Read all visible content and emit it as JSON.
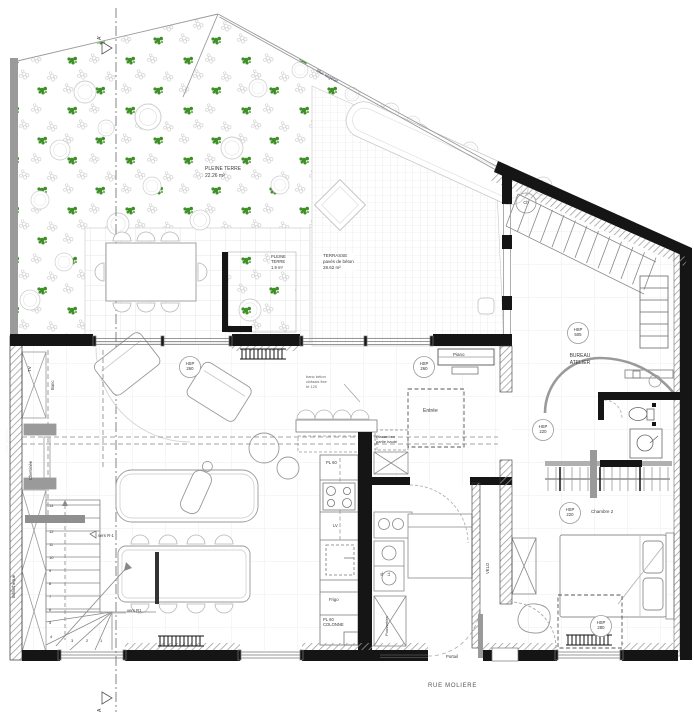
{
  "plan": {
    "street_name": "RUE MOLIERE",
    "gate_label": "Portail",
    "section_marker_top": "A'",
    "section_marker_bottom": "A"
  },
  "garden": {
    "mur_vegetal_left": "Mur végétal",
    "mur_vegetal_diagonal": "Mur végétal",
    "pleine_terre_large_lines": [
      "PLEINE TERRE",
      "22.26 m²"
    ],
    "pleine_terre_small_lines": [
      "PLEINE",
      "TERRE",
      "1.9 m²"
    ],
    "terrasse_lines": [
      "TERRASSE",
      "pavés de béton",
      "28.62 m²"
    ]
  },
  "rooms": {
    "bureau_atelier_lines": [
      "BUREAU",
      "ATELIER"
    ],
    "chambre2": "Chambre 2",
    "entree": "Entrée"
  },
  "labels": {
    "piano": "Piano",
    "ch": "Ch",
    "tv": "TV",
    "banc": "Banc",
    "cheminee": "Cheminée",
    "bibliotheque": "Bibliothèque",
    "pl60": "PL 60",
    "lv": "LV",
    "frigo": "Frigo",
    "pl60_colonne_lines": [
      "PL 60",
      "COLONNE"
    ],
    "placard_lines": [
      "Placard en",
      "partie haute"
    ],
    "poussettes": "Poussettes",
    "sl": "SL",
    "ll": "LL",
    "velo": "VELO",
    "vers_r_moins1": "vers R-1",
    "vers_r1": "vers R1",
    "banc_beton_lines": [
      "banc béton",
      "châssis fixe",
      "ht 120"
    ]
  },
  "hsp": {
    "sejour": [
      "HSP",
      "260"
    ],
    "hall": [
      "HSP",
      "260"
    ],
    "bureau": [
      "HSP",
      "505"
    ],
    "passage": [
      "HSP",
      "220"
    ],
    "chambre": [
      "HSP",
      "220"
    ],
    "lit": [
      "HSP",
      "280"
    ]
  },
  "stairs": {
    "numbers": [
      "14",
      "12",
      "11",
      "10",
      "9",
      "8",
      "7",
      "6",
      "5",
      "4",
      "3",
      "2",
      "1"
    ]
  },
  "colors": {
    "wall_black": "#151515",
    "wall_grey": "#9a9a9a",
    "plant_green": "#3f8f28",
    "grid_light": "#dcdcdc",
    "text": "#3a3a3a"
  }
}
